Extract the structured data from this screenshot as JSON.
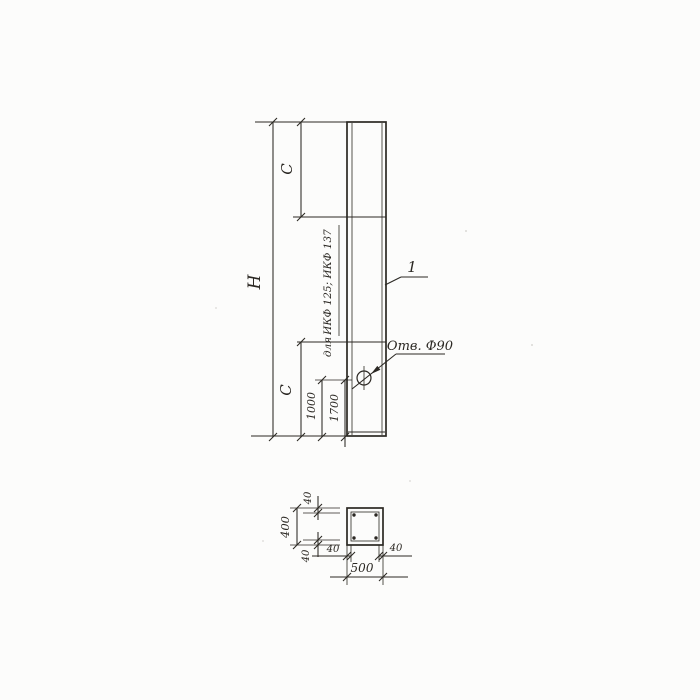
{
  "drawing": {
    "elevation": {
      "labels": {
        "overall_height": "H",
        "c_top": "C",
        "c_bottom": "C",
        "hole_offset_1": "1000",
        "hole_offset_2": "1700",
        "note_for": "для",
        "note_series": "ИКФ 125; ИКФ 137",
        "hole_callout": "Отв. Ф90",
        "part_number": "1"
      }
    },
    "section": {
      "labels": {
        "overall_width": "500",
        "overall_height": "400",
        "wall_top": "40",
        "wall_bottom": "40",
        "wall_left": "40",
        "wall_right": "40"
      }
    },
    "colors": {
      "ink": "#2b2823",
      "paper": "#fcfcfb"
    }
  }
}
